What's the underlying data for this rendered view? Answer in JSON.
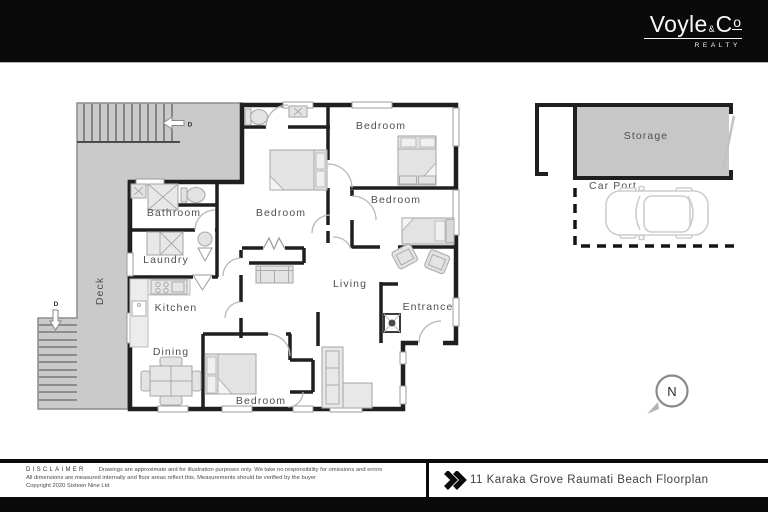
{
  "header": {
    "brand_word_1": "Voyle",
    "brand_amp": "&",
    "brand_word_2": "C",
    "brand_word_2_sup": "o",
    "brand_tagline": "REALTY"
  },
  "floorplan": {
    "rooms": {
      "bedroom_top": "Bedroom",
      "bedroom_mid": "Bedroom",
      "bedroom_right": "Bedroom",
      "bedroom_bottom": "Bedroom",
      "bathroom": "Bathroom",
      "laundry": "Laundry",
      "kitchen": "Kitchen",
      "dining": "Dining",
      "living": "Living",
      "entrance": "Entrance",
      "deck": "Deck",
      "storage": "Storage",
      "carport": "Car Port"
    },
    "markers": {
      "stair_top": "D",
      "stair_bottom": "D",
      "compass_north": "N"
    },
    "icons": {
      "compass": "north-arrow",
      "stairs_top_arrow": "arrow-left",
      "stairs_bottom_arrow": "arrow-down",
      "footer_marker": "double-chevron-right"
    },
    "colors": {
      "deck_gray": "#cacaca",
      "storage_gray": "#c7c7c7",
      "wall_black": "#1f1f1f",
      "label_gray": "#4f4f4f"
    }
  },
  "footer": {
    "disclaimer_heading": "DISCLAIMER",
    "disclaimer_lines": [
      "Drawings are approximate and for illustration purposes only. We take no responsibility for omissions and errors",
      "All dimensions are measured internally and floor areas reflect this. Measurements should be verified by the buyer",
      "Copyright 2020 Sixteen Nine Ltd"
    ],
    "plan_title": "11 Karaka Grove Raumati Beach Floorplan"
  }
}
